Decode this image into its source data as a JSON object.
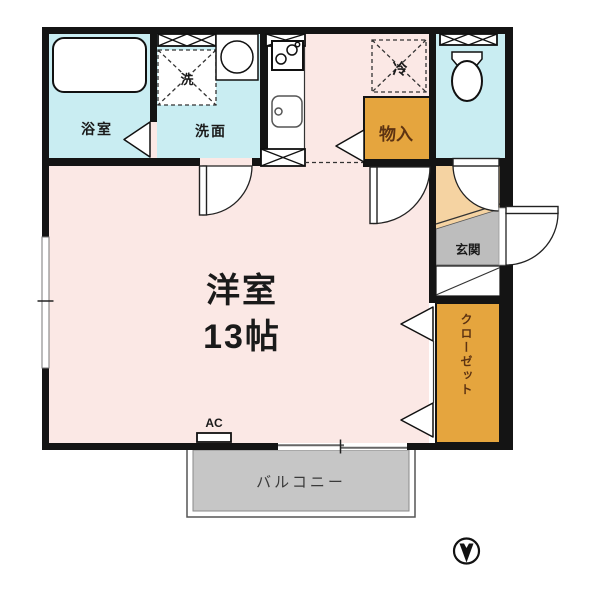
{
  "diagram": {
    "type": "apartment-floor-plan",
    "rooms": {
      "bathroom": {
        "label": "浴室"
      },
      "washroom": {
        "label": "洗面"
      },
      "main_room": {
        "label": "洋室",
        "size": "13帖"
      },
      "entrance": {
        "label": "玄関"
      },
      "closet": {
        "label": "クローゼット"
      },
      "storage": {
        "label": "物入"
      },
      "balcony": {
        "label": "バルコニー"
      }
    },
    "fixtures": {
      "washer_pan": {
        "label": "洗"
      },
      "refrigerator_space": {
        "label": "冷"
      },
      "air_conditioner": {
        "label": "AC"
      }
    },
    "icons": [
      "bathtub-icon",
      "washbasin-icon",
      "stove-icon",
      "kitchen-sink-icon",
      "toilet-icon",
      "north-arrow-icon"
    ],
    "compass": {
      "direction": "down"
    },
    "colors": {
      "room_pink": "#fbe8e5",
      "wet_area_cyan": "#c9edf2",
      "storage_orange": "#e5a53e",
      "hall_peach": "#f5d3a2",
      "entry_gray": "#bdbdbd",
      "balcony_gray": "#c6c6c6",
      "wall": "#141414",
      "storage_text_brown": "#5d3312"
    }
  }
}
